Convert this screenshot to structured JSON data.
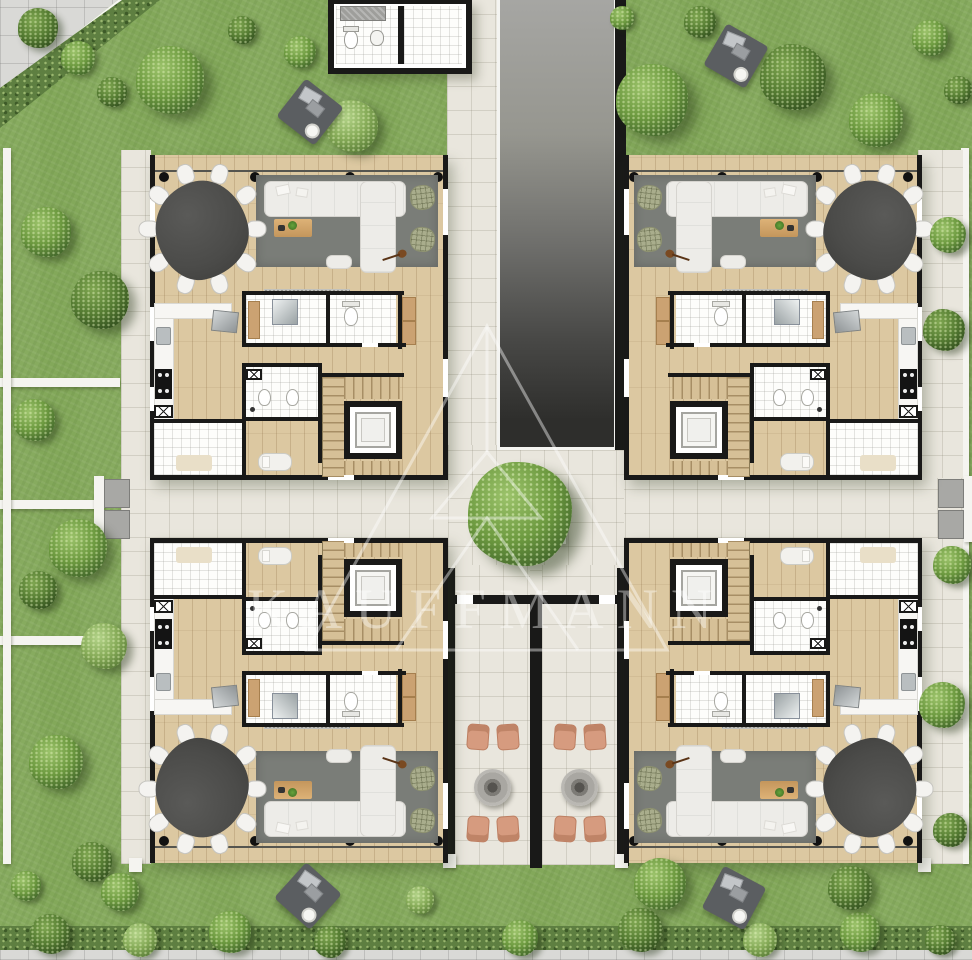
{
  "watermark": {
    "text": "KAUFFMANN",
    "logo": "pyramid-triangle-outline",
    "color": "#ffffff",
    "opacity": 0.4
  },
  "plan": {
    "kind": "residential floor plan, top view render",
    "units": [
      {
        "id": "apartment-unit-top-left",
        "x": 150,
        "y": 155,
        "sx": 1,
        "sy": 1
      },
      {
        "id": "apartment-unit-top-right",
        "x": 624,
        "y": 155,
        "sx": -1,
        "sy": 1
      },
      {
        "id": "apartment-unit-bottom-left",
        "x": 150,
        "y": 538,
        "sx": 1,
        "sy": -1
      },
      {
        "id": "apartment-unit-bottom-right",
        "x": 624,
        "y": 538,
        "sx": -1,
        "sy": -1
      }
    ],
    "unit_rooms": [
      "terrace",
      "living room",
      "dining area",
      "kitchen",
      "bathroom",
      "toilets",
      "laundry",
      "hall",
      "elevator",
      "staircase"
    ],
    "unit_furniture": [
      "organic dining table",
      "dining chairs x10",
      "corner sofa",
      "coffee table with plant",
      "area rug",
      "wicker armchairs x2",
      "guitar",
      "runner rug",
      "kitchen counter",
      "cooktop",
      "sink",
      "fridge",
      "toilet",
      "shower glass",
      "vanity",
      "wardrobe",
      "daybed"
    ],
    "core": {
      "driveway_ramp": true,
      "entrance_wc": true
    },
    "courtyard": {
      "tree_in_planter": true
    },
    "patios": [
      {
        "chairs": 4,
        "fire_pit": 1
      },
      {
        "chairs": 4,
        "fire_pit": 1
      }
    ]
  },
  "colors": {
    "grass": "#83a85a",
    "hedge": "#5e7f41",
    "wood": "#dcc8a1",
    "paving": "#e9e6dd",
    "sidewalk": "#d9d9d6",
    "wall": "#191918",
    "white_wall": "#f5f4f0",
    "ramp_top": "#a6a6a3",
    "ramp_bottom": "#2e2e2c",
    "rug": "#7a7d78",
    "sofa": "#edece8",
    "dining_table": "#4b4b49",
    "wicker": "#a9ad8c",
    "patio_chair": "#d69b7f",
    "fire_pit": "#a9a7a2",
    "tree_hi": "#9cc36b",
    "tree_mid": "#6d9a40",
    "tree_lo": "#41652a",
    "counter": "#f7f6f3",
    "cooktop": "#141414",
    "coffee_table": "#d3a368",
    "blanket": "#5b5e61",
    "steps": "#a8a8a5"
  },
  "scene": {
    "canvas": {
      "w": 972,
      "h": 960
    },
    "sidewalk_corner": [
      [
        0,
        0
      ],
      [
        118,
        0
      ],
      [
        0,
        92
      ]
    ],
    "hedge_diagonal": [
      [
        0,
        88
      ],
      [
        122,
        0
      ],
      [
        160,
        0
      ],
      [
        0,
        128
      ]
    ],
    "curb_diagonal": [
      [
        0,
        92
      ],
      [
        118,
        0
      ],
      [
        126,
        0
      ],
      [
        0,
        100
      ]
    ],
    "bottom_hedge": {
      "x": 0,
      "y": 926,
      "w": 972,
      "h": 28
    },
    "bottom_sidewalk": {
      "x": 0,
      "y": 950,
      "w": 972,
      "h": 10
    },
    "walkway_left": {
      "x": 121,
      "y": 150,
      "w": 30,
      "h": 714
    },
    "walkway_right": {
      "x": 918,
      "y": 150,
      "w": 45,
      "h": 714
    },
    "walkway_top": {
      "x": 447,
      "y": 0,
      "w": 50,
      "h": 447
    },
    "corridor": {
      "x": 121,
      "y": 478,
      "w": 842,
      "h": 60
    },
    "courtyard": {
      "x": 448,
      "y": 445,
      "w": 176,
      "h": 150
    },
    "ramp": {
      "x": 497,
      "y": 0,
      "w": 120,
      "h": 450
    },
    "ramp_wall": {
      "x": 615,
      "y": 0,
      "w": 11,
      "h": 450
    },
    "wc_block": {
      "x": 328,
      "y": 0,
      "w": 144,
      "h": 74
    },
    "patio_block": {
      "x": 443,
      "y": 565,
      "w": 186,
      "h": 303
    },
    "planter": {
      "x": 490,
      "y": 488,
      "w": 76,
      "h": 56
    },
    "tree_center": {
      "x": 520,
      "y": 514,
      "r": 52
    },
    "garden_walls": [
      {
        "x": 0,
        "y": 378,
        "w": 120,
        "h": 9
      },
      {
        "x": 0,
        "y": 500,
        "w": 98,
        "h": 9
      },
      {
        "x": 0,
        "y": 636,
        "w": 120,
        "h": 9
      },
      {
        "x": 3,
        "y": 148,
        "w": 8,
        "h": 716
      },
      {
        "x": 961,
        "y": 148,
        "w": 8,
        "h": 716
      }
    ],
    "gates": [
      {
        "x": 94,
        "y": 476,
        "flip": 1
      },
      {
        "x": 936,
        "y": 476,
        "flip": -1
      }
    ],
    "posts": [
      [
        129,
        858
      ],
      [
        918,
        858
      ],
      [
        443,
        854
      ],
      [
        615,
        854
      ]
    ],
    "blankets": [
      {
        "x": 310,
        "y": 112,
        "rot": 38
      },
      {
        "x": 736,
        "y": 56,
        "rot": 30
      },
      {
        "x": 308,
        "y": 896,
        "rot": 42
      },
      {
        "x": 734,
        "y": 898,
        "rot": 28
      }
    ],
    "trees": [
      [
        38,
        28,
        20,
        0
      ],
      [
        78,
        58,
        17,
        1
      ],
      [
        112,
        92,
        15,
        0
      ],
      [
        170,
        80,
        34,
        1
      ],
      [
        300,
        52,
        16,
        1
      ],
      [
        352,
        126,
        26,
        2
      ],
      [
        242,
        30,
        14,
        0
      ],
      [
        652,
        100,
        36,
        1
      ],
      [
        793,
        77,
        33,
        0
      ],
      [
        876,
        120,
        27,
        1
      ],
      [
        700,
        22,
        16,
        0
      ],
      [
        930,
        38,
        18,
        1
      ],
      [
        958,
        90,
        14,
        0
      ],
      [
        622,
        18,
        12,
        1
      ],
      [
        46,
        232,
        25,
        1
      ],
      [
        100,
        300,
        29,
        0
      ],
      [
        34,
        420,
        21,
        1
      ],
      [
        78,
        548,
        29,
        1
      ],
      [
        38,
        590,
        19,
        0
      ],
      [
        104,
        646,
        23,
        2
      ],
      [
        56,
        762,
        27,
        1
      ],
      [
        92,
        862,
        20,
        0
      ],
      [
        26,
        886,
        15,
        1
      ],
      [
        948,
        235,
        18,
        1
      ],
      [
        944,
        330,
        21,
        0
      ],
      [
        952,
        565,
        19,
        1
      ],
      [
        942,
        705,
        23,
        1
      ],
      [
        950,
        830,
        17,
        0
      ],
      [
        50,
        934,
        20,
        0
      ],
      [
        140,
        940,
        17,
        2
      ],
      [
        230,
        932,
        21,
        1
      ],
      [
        330,
        942,
        16,
        0
      ],
      [
        520,
        938,
        18,
        1
      ],
      [
        640,
        930,
        22,
        0
      ],
      [
        760,
        940,
        17,
        2
      ],
      [
        860,
        932,
        20,
        1
      ],
      [
        940,
        940,
        15,
        0
      ],
      [
        120,
        892,
        19,
        1
      ],
      [
        660,
        884,
        26,
        1
      ],
      [
        850,
        888,
        22,
        0
      ],
      [
        420,
        900,
        14,
        2
      ]
    ]
  }
}
